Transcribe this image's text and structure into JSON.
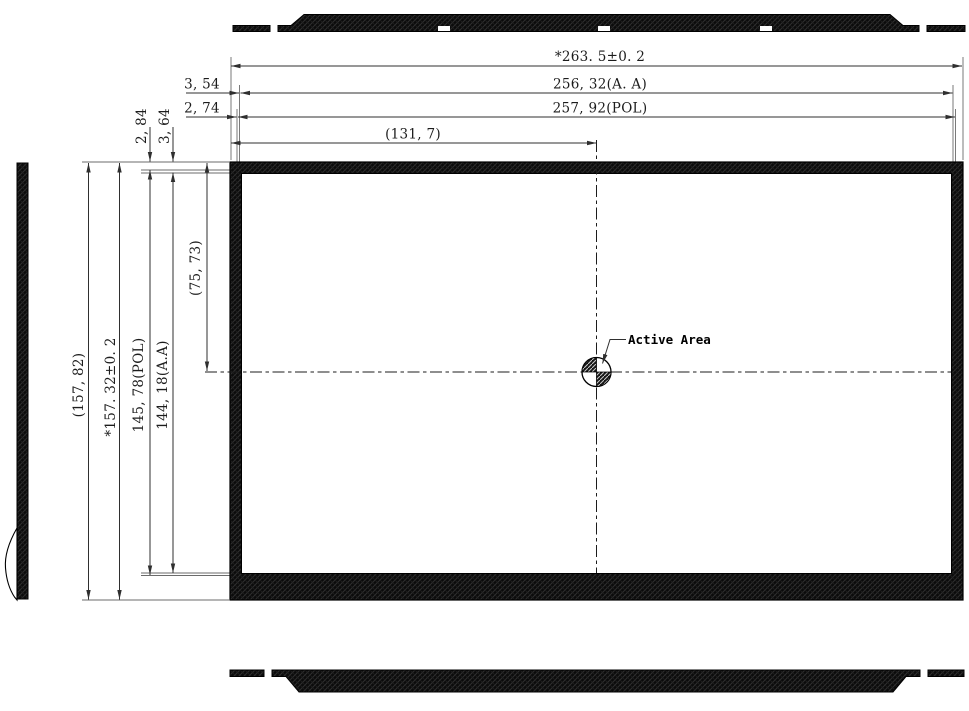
{
  "dims": {
    "horizontal": {
      "overall": "*263. 5±0. 2",
      "active_area": "256, 32(A. A)",
      "polarizer": "257, 92(POL)",
      "to_center": "(131, 7)",
      "edge_to_aa": "3, 54",
      "edge_to_pol": "2, 74"
    },
    "vertical": {
      "overall_ref": "(157, 82)",
      "overall": "*157. 32±0. 2",
      "polarizer": "145, 78(POL)",
      "active_area": "144, 18(A.A)",
      "to_center": "(75, 73)",
      "edge_to_pol": "2, 84",
      "edge_to_aa": "3, 64"
    },
    "active_area_label": "Active Area"
  },
  "colors": {
    "ink": "#1c1c1c",
    "dimension_line": "#2f2f2f",
    "extension_line": "#6b6b6b",
    "panel_fill": "#0b0b0b",
    "background": "#ffffff"
  }
}
